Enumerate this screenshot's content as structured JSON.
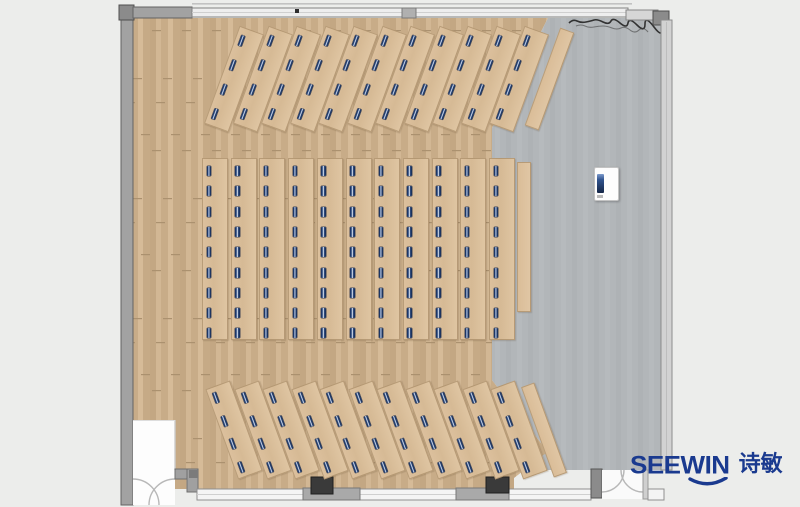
{
  "meta": {
    "view_title": "classroom-floor-plan",
    "description": "Top-down floor plan render of a lecture room with fanned desk rows, a center desk grid, a podium and entry doors"
  },
  "brand": {
    "logo_text": "SEEWIN",
    "logo_cn": "诗敏",
    "logo_color": "#1a3a8f"
  },
  "colors": {
    "bg": "#ecedeb",
    "wood": "#cbb08d",
    "desk": "#d9bd98",
    "gray_floor": "#b2b6b9",
    "wall": "#a2a2a2",
    "seat": "#1c3666",
    "logo_blue": "#1a3a8f"
  },
  "floorplan": {
    "groups": [
      {
        "name": "top-fan-row",
        "desks": 11,
        "seats": 4,
        "cx0": 234,
        "cy": 79,
        "dx": 28.5,
        "w": 26,
        "h": 104,
        "rot": 20,
        "seat_top": 7,
        "seat_gap": 26,
        "seat_small": false
      },
      {
        "name": "top-side-table",
        "desks": 1,
        "seats": 0,
        "cx0": 549,
        "cy": 79,
        "dx": 0,
        "w": 15,
        "h": 104,
        "rot": 20,
        "plain": true
      },
      {
        "name": "center-desk-grid",
        "desks": 11,
        "seats": 9,
        "cx0": 215,
        "cy": 249,
        "dx": 28.7,
        "w": 26,
        "h": 182,
        "rot": 0,
        "seat_top": 7,
        "seat_gap": 20.3,
        "seat_small": true
      },
      {
        "name": "center-side-table",
        "desks": 1,
        "seats": 0,
        "cx0": 524,
        "cy": 237,
        "dx": 0,
        "w": 14,
        "h": 150,
        "rot": 0,
        "plain": true
      },
      {
        "name": "bottom-fan-row",
        "desks": 11,
        "seats": 4,
        "cx0": 234,
        "cy": 430,
        "dx": 28.5,
        "w": 26,
        "h": 96,
        "rot": -20,
        "seat_top": 5,
        "seat_gap": 24.5,
        "seat_small": false
      },
      {
        "name": "bottom-side-table",
        "desks": 1,
        "seats": 0,
        "cx0": 544,
        "cy": 430,
        "dx": 0,
        "w": 14,
        "h": 96,
        "rot": -20,
        "plain": true
      }
    ],
    "podium": {
      "x": 594,
      "y": 167,
      "w": 25,
      "h": 34
    },
    "totals": {
      "top_seats": 44,
      "center_seats": 99,
      "bottom_seats": 44
    }
  }
}
